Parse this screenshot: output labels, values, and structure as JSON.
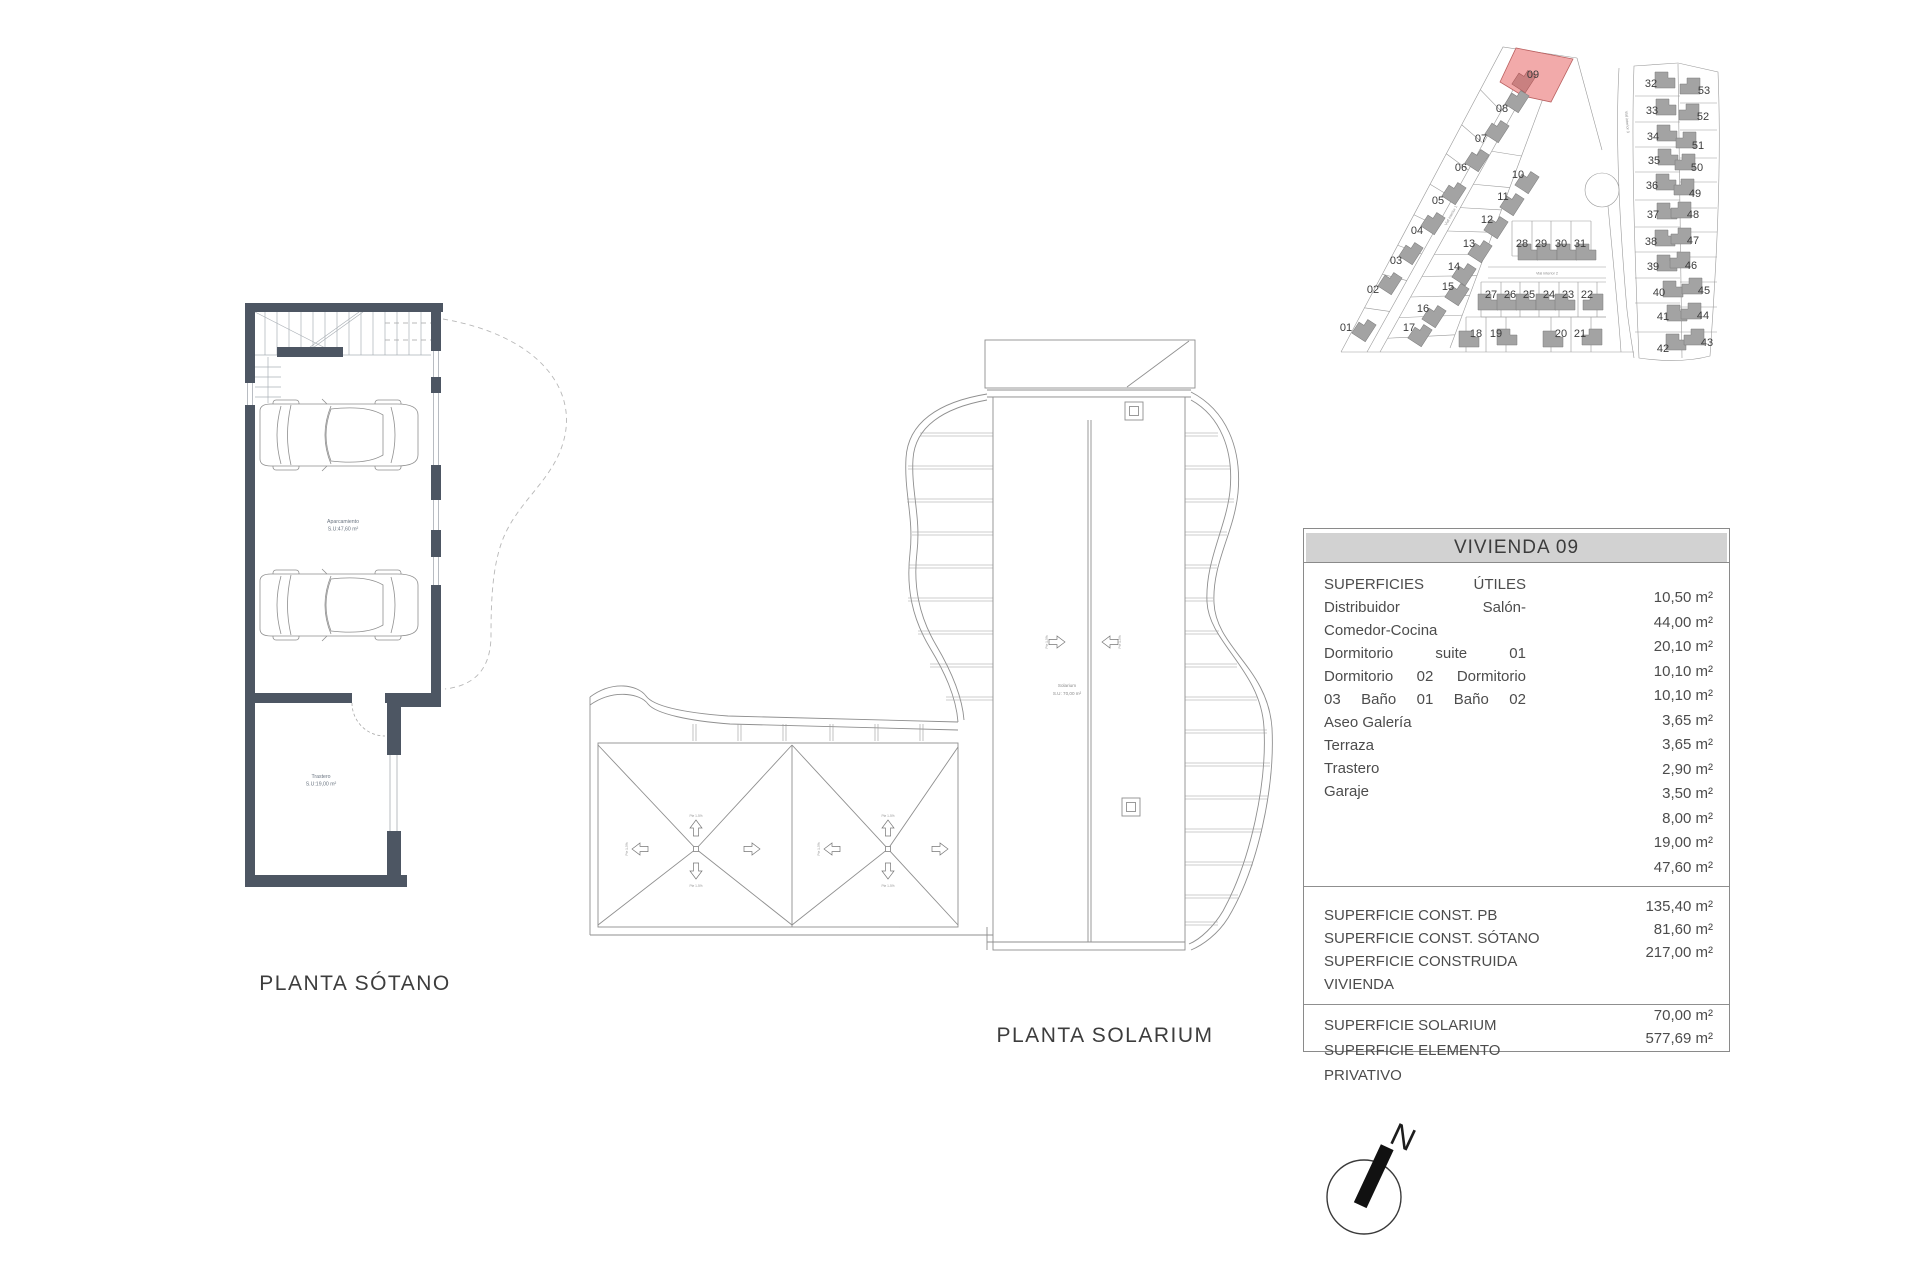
{
  "titles": {
    "basement": "PLANTA SÓTANO",
    "solarium": "PLANTA SOLARIUM"
  },
  "basement_plan": {
    "parking_label": "Aparcamiento",
    "parking_area": "S.U:47,60 m²",
    "storage_label": "Trastero",
    "storage_area": "S.U:19,00 m²"
  },
  "solarium_plan": {
    "room_label": "Solarium",
    "room_area": "S.U: 70,00 m²",
    "slope_label": "Pte 1-5%"
  },
  "site_plan": {
    "highlighted_plot": "09",
    "highlight_fill": "#f2aaaa",
    "highlight_house": "#c98080",
    "house_fill": "#a3a3a3",
    "road_labels": [
      "Vial interior 1",
      "Vial interior 2",
      "Vial interior 3"
    ],
    "plots": [
      [
        "01",
        6,
        297,
        24,
        299,
        -57,
        ""
      ],
      [
        "02",
        33,
        259,
        50,
        252,
        -57,
        ""
      ],
      [
        "03",
        56,
        230,
        71,
        222,
        -57,
        ""
      ],
      [
        "04",
        77,
        200,
        93,
        192,
        -57,
        ""
      ],
      [
        "05",
        98,
        170,
        114,
        162,
        -57,
        ""
      ],
      [
        "06",
        121,
        137,
        137,
        129,
        -57,
        ""
      ],
      [
        "07",
        141,
        108,
        157,
        100,
        -57,
        ""
      ],
      [
        "08",
        162,
        78,
        177,
        70,
        -57,
        ""
      ],
      [
        "09",
        193,
        44,
        184,
        50,
        -57,
        "r"
      ],
      [
        "10",
        178,
        144,
        187,
        151,
        -57,
        ""
      ],
      [
        "11",
        163,
        166,
        172,
        173,
        -57,
        ""
      ],
      [
        "12",
        147,
        189,
        156,
        196,
        -57,
        ""
      ],
      [
        "13",
        129,
        213,
        140,
        220,
        -57,
        ""
      ],
      [
        "14",
        114,
        236,
        124,
        243,
        -57,
        ""
      ],
      [
        "15",
        108,
        256,
        117,
        263,
        -57,
        ""
      ],
      [
        "16",
        83,
        278,
        94,
        285,
        -57,
        ""
      ],
      [
        "17",
        69,
        297,
        80,
        304,
        -57,
        ""
      ],
      [
        "28",
        182,
        213,
        188,
        222,
        0,
        ""
      ],
      [
        "29",
        201,
        213,
        207,
        222,
        0,
        ""
      ],
      [
        "30",
        221,
        213,
        227,
        222,
        0,
        ""
      ],
      [
        "31",
        240,
        213,
        246,
        222,
        0,
        ""
      ],
      [
        "27",
        151,
        264,
        148,
        272,
        0,
        ""
      ],
      [
        "26",
        170,
        264,
        167,
        272,
        0,
        ""
      ],
      [
        "25",
        189,
        264,
        186,
        272,
        0,
        ""
      ],
      [
        "24",
        209,
        264,
        206,
        272,
        0,
        ""
      ],
      [
        "23",
        228,
        264,
        225,
        272,
        0,
        ""
      ],
      [
        "22",
        247,
        264,
        253,
        272,
        0,
        "m"
      ],
      [
        "18",
        136,
        303,
        129,
        309,
        0,
        ""
      ],
      [
        "19",
        156,
        303,
        167,
        307,
        0,
        ""
      ],
      [
        "20",
        221,
        303,
        213,
        309,
        0,
        ""
      ],
      [
        "21",
        240,
        303,
        252,
        307,
        0,
        "m"
      ],
      [
        "32",
        311,
        53,
        325,
        50,
        0,
        ""
      ],
      [
        "33",
        312,
        80,
        326,
        77,
        0,
        ""
      ],
      [
        "34",
        313,
        106,
        327,
        103,
        0,
        ""
      ],
      [
        "35",
        314,
        130,
        328,
        127,
        0,
        ""
      ],
      [
        "36",
        312,
        155,
        326,
        152,
        0,
        ""
      ],
      [
        "37",
        313,
        184,
        327,
        181,
        0,
        ""
      ],
      [
        "38",
        311,
        211,
        325,
        208,
        0,
        ""
      ],
      [
        "39",
        313,
        236,
        327,
        233,
        0,
        ""
      ],
      [
        "40",
        319,
        262,
        333,
        259,
        0,
        ""
      ],
      [
        "41",
        323,
        286,
        337,
        283,
        0,
        ""
      ],
      [
        "42",
        323,
        318,
        336,
        312,
        0,
        ""
      ],
      [
        "53",
        364,
        60,
        350,
        56,
        0,
        "m"
      ],
      [
        "52",
        363,
        86,
        349,
        82,
        0,
        "m"
      ],
      [
        "51",
        358,
        115,
        346,
        110,
        0,
        "m"
      ],
      [
        "50",
        357,
        137,
        345,
        132,
        0,
        "m"
      ],
      [
        "49",
        355,
        163,
        344,
        157,
        0,
        "m"
      ],
      [
        "48",
        353,
        184,
        341,
        180,
        0,
        "m"
      ],
      [
        "47",
        353,
        210,
        341,
        206,
        0,
        "m"
      ],
      [
        "46",
        351,
        235,
        340,
        230,
        0,
        "m"
      ],
      [
        "45",
        364,
        260,
        352,
        256,
        0,
        "m"
      ],
      [
        "44",
        363,
        285,
        351,
        281,
        0,
        "m"
      ],
      [
        "43",
        367,
        312,
        354,
        307,
        0,
        "m"
      ]
    ]
  },
  "table": {
    "title": "VIVIENDA 09",
    "sections": [
      {
        "labels": [
          {
            "t": "SUPERFICIES ÚTILES",
            "j": 1
          },
          {
            "t": "Distribuidor Salón-",
            "j": 1
          },
          {
            "t": "Comedor-Cocina"
          },
          {
            "t": "Dormitorio suite 01",
            "j": 1
          },
          {
            "t": "Dormitorio 02 Dormitorio",
            "j": 1
          },
          {
            "t": "03 Baño 01 Baño 02",
            "j": 1
          },
          {
            "t": "Aseo Galería"
          },
          {
            "t": "Terraza"
          },
          {
            "t": "Trastero"
          },
          {
            "t": "Garaje"
          }
        ],
        "values": [
          "10,50 m²",
          "44,00 m²",
          "20,10 m²",
          "10,10 m²",
          "10,10 m²",
          "3,65 m²",
          "3,65 m²",
          "2,90 m²",
          "3,50 m²",
          "8,00 m²",
          "19,00 m²",
          "47,60 m²"
        ]
      },
      {
        "labels": [
          {
            "t": "SUPERFICIE CONST. PB"
          },
          {
            "t": "SUPERFICIE CONST. SÓTANO"
          },
          {
            "t": "SUPERFICIE CONSTRUIDA VIVIENDA"
          }
        ],
        "values": [
          "135,40 m²",
          "81,60 m²",
          "217,00 m²"
        ]
      },
      {
        "labels": [
          {
            "t": "SUPERFICIE SOLARIUM"
          },
          {
            "t": "SUPERFICIE ELEMENTO PRIVATIVO"
          }
        ],
        "values": [
          "70,00 m²",
          "577,69 m²"
        ]
      }
    ]
  },
  "compass": {
    "north_label": "N"
  }
}
